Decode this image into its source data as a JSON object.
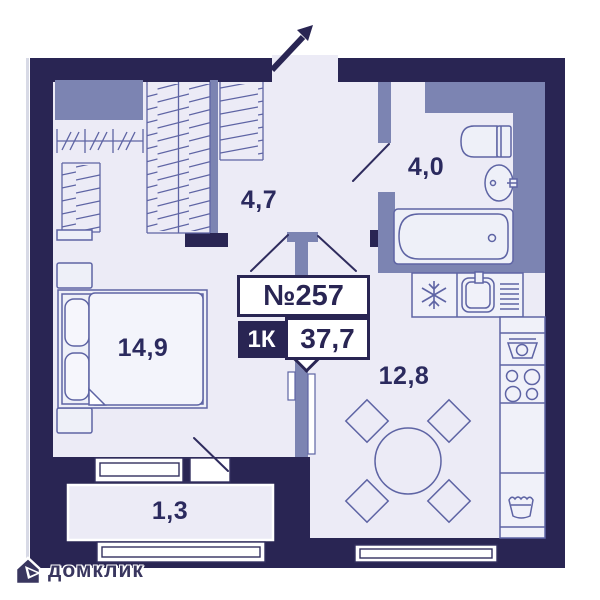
{
  "unit": {
    "number": "№257",
    "rooms_label": "1К",
    "area": "37,7"
  },
  "rooms": {
    "hall": {
      "label": "4,7"
    },
    "bathroom": {
      "label": "4,0"
    },
    "bedroom": {
      "label": "14,9"
    },
    "kitchen": {
      "label": "12,8"
    },
    "balcony": {
      "label": "1,3"
    }
  },
  "watermark": {
    "text": "домклик"
  },
  "colors": {
    "wall": "#292553",
    "partition": "#7c84b2",
    "floor": "#ecebf6",
    "furniture_line": "#5e64a4",
    "label_text": "#2b2a5e",
    "window_fill": "#ffffff"
  }
}
